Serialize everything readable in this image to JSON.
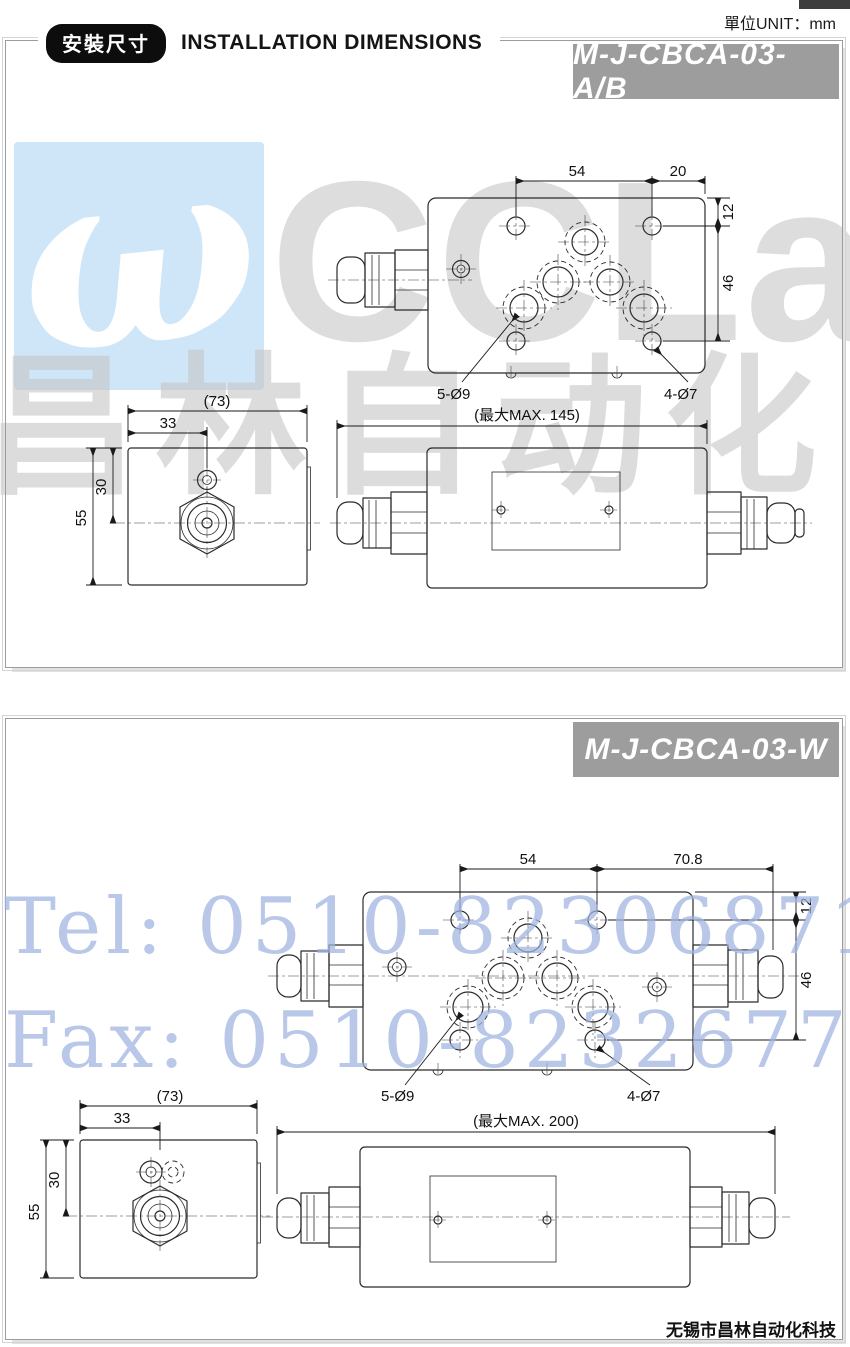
{
  "page": {
    "unit_label": "單位UNIT：mm",
    "section_badge": "安裝尺寸",
    "section_title": "INSTALLATION DIMENSIONS",
    "footer_company": "无锡市昌林自动化科技"
  },
  "watermark": {
    "logo_glyph": "ω",
    "brand_text": "CCLair",
    "brand_text_cn": "昌林自动化",
    "tel": "Tel: 0510-82306871",
    "fax": "Fax: 0510-82326771",
    "colors": {
      "logo_box": "#cfe5f8",
      "contact_text": "#9fb4e0",
      "brand_gray": "#bcbcbc",
      "model_badge": "#9d9d9d"
    }
  },
  "panel1": {
    "model": "M-J-CBCA-03-A/B",
    "top_view": {
      "dim_54": "54",
      "dim_20": "20",
      "dim_12": "12",
      "dim_46": "46",
      "label_mount_holes": "5-Ø9",
      "label_port_holes": "4-Ø7"
    },
    "side_view": {
      "dim_73": "(73)",
      "dim_33": "33",
      "dim_30": "30",
      "dim_55": "55"
    },
    "front_view": {
      "dim_max": "(最大MAX. 145)"
    }
  },
  "panel2": {
    "model": "M-J-CBCA-03-W",
    "top_view": {
      "dim_54": "54",
      "dim_70_8": "70.8",
      "dim_12": "12",
      "dim_46": "46",
      "label_mount_holes": "5-Ø9",
      "label_port_holes": "4-Ø7"
    },
    "side_view": {
      "dim_73": "(73)",
      "dim_33": "33",
      "dim_30": "30",
      "dim_55": "55"
    },
    "front_view": {
      "dim_max": "(最大MAX. 200)"
    }
  }
}
